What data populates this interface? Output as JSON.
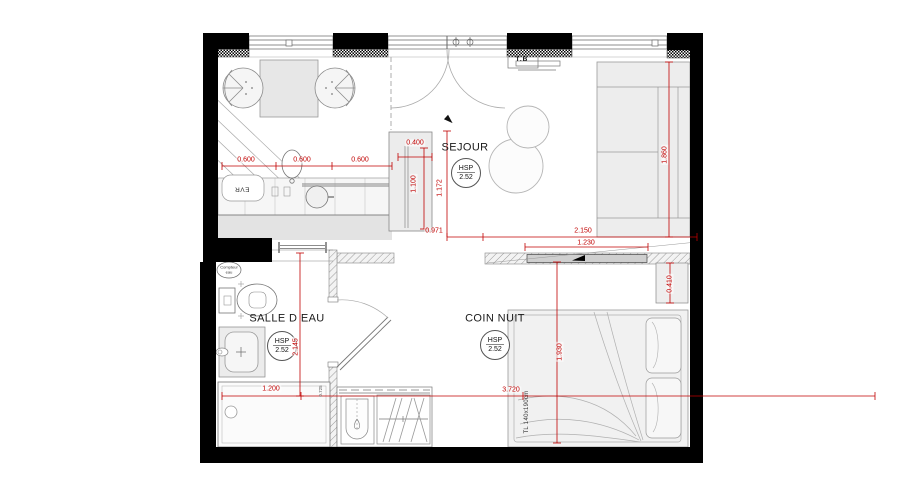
{
  "rooms": {
    "sejour": {
      "label": "SEJOUR",
      "hsp_label": "HSP",
      "hsp_value": "2.52"
    },
    "coin_nuit": {
      "label": "COIN NUIT",
      "hsp_label": "HSP",
      "hsp_value": "2.52"
    },
    "salle_d_eau": {
      "label": "SALLE D EAU",
      "hsp_label": "HSP",
      "hsp_value": "2.52"
    }
  },
  "dimensions": {
    "kitchen_run_1": "0.600",
    "kitchen_run_2": "0.600",
    "kitchen_run_3": "0.600",
    "tall_unit_width": "0.400",
    "tall_unit_depth": "1.100",
    "sejour_depth": "1.172",
    "passage_width": "0.971",
    "partition_length": "2.150",
    "sliding_door_width": "1.230",
    "shelf_depth": "0.410",
    "sofa_length": "1.860",
    "bed_area_depth": "1.930",
    "coin_nuit_width": "3.720",
    "shower_width": "1.200",
    "salle_d_eau_depth": "2.145",
    "shower_side_note": "0.725"
  },
  "labels": {
    "electrical_board": "T.B",
    "kitchen_sink": "EVR",
    "water_meter_line1": "Compteur",
    "water_meter_line2": "eau",
    "bed_size": "TL 140x190cm"
  },
  "colors": {
    "dimension_red": "#c00000",
    "wall_black": "#000000"
  }
}
